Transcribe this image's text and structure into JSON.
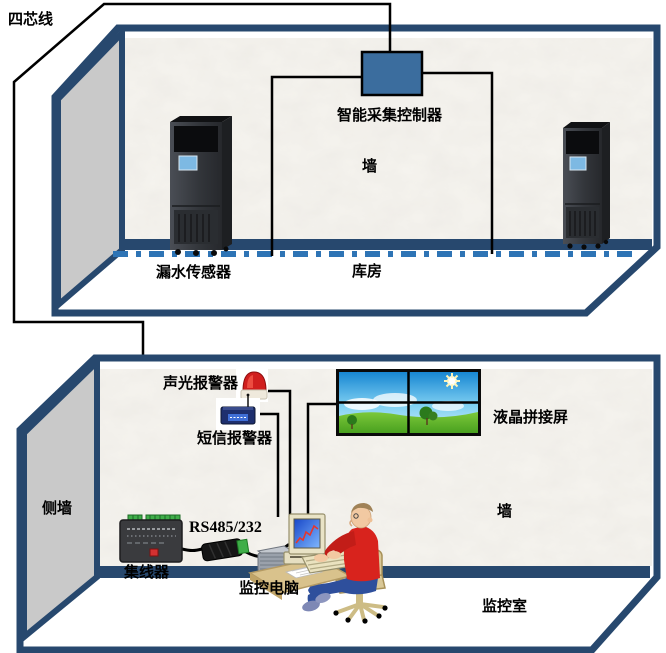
{
  "title": "机房漏水监控系统示意图",
  "labels": {
    "four_core_wire": "四芯线",
    "controller": "智能采集控制器",
    "wall_top": "墙",
    "leak_sensor": "漏水传感器",
    "warehouse": "库房",
    "sound_light_alarm": "声光报警器",
    "sms_alarm": "短信报警器",
    "lcd_wall": "液晶拼接屏",
    "side_wall": "侧墙",
    "rs485": "RS485/232",
    "hub": "集线器",
    "monitor_pc": "监控电脑",
    "wall_bottom": "墙",
    "monitor_room": "监控室"
  },
  "colors": {
    "room_border_navy": "#27486e",
    "wall_gray": "#c9c9c9",
    "wall_paper": "#f6f4ef",
    "controller_blue": "#3b6d9e",
    "leak_cable_blue": "#2e74b5",
    "wire_black": "#000000",
    "beacon_red": "#d01e1e",
    "sms_modem_navy": "#1e2f6e",
    "terminal_green": "#3fae49",
    "hub_body": "#3a3b3e",
    "button_red": "#d33131",
    "computer_beige": "#e9e3c6",
    "crt_blue": "#1848c8",
    "graph_red": "#e4372e",
    "sweater_red": "#d8231d",
    "jeans_blue": "#2e4f9c",
    "chair_tan": "#d9c897",
    "grass_green": "#5cb42c",
    "sky_blue": "#1786d2"
  },
  "devices": [
    "cabinet-ac-unit-left",
    "cabinet-ac-unit-right",
    "acquisition-controller-box",
    "leak-sensor-cable",
    "alarm-beacon",
    "sms-alarm-modem",
    "lcd-video-wall",
    "hub-device",
    "rs485-adapter",
    "printer-device",
    "monitoring-computer",
    "operator-person",
    "office-chair",
    "desk"
  ]
}
